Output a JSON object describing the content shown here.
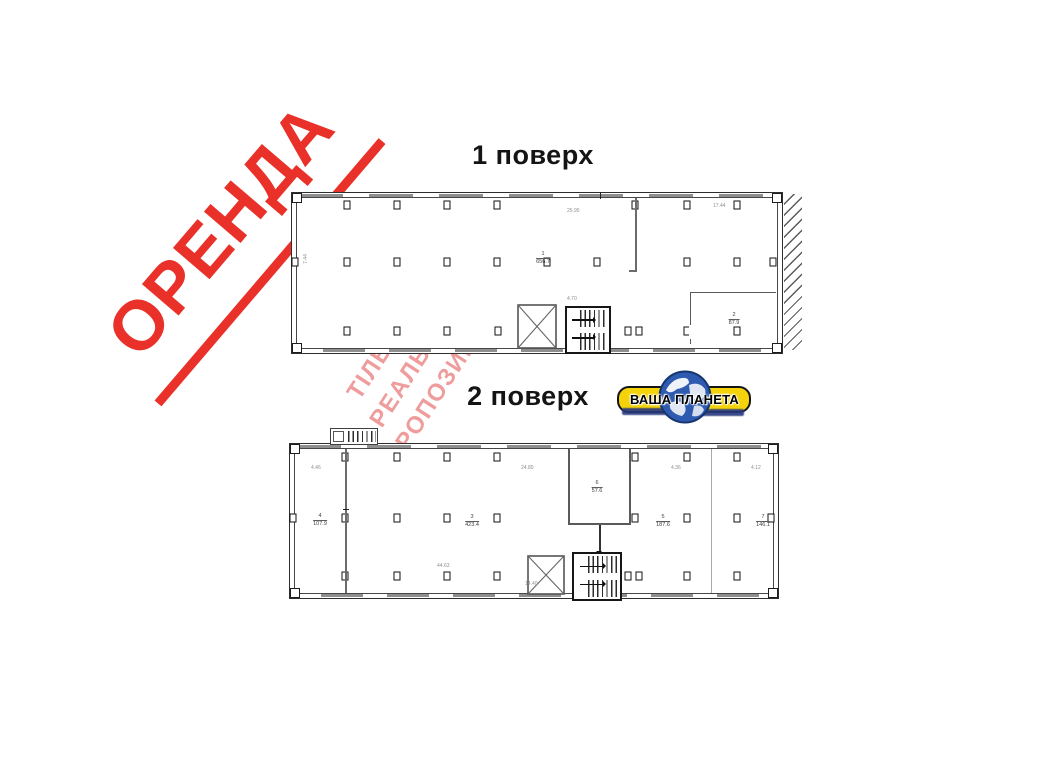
{
  "colors": {
    "stamp_red": "#e9312a",
    "watermark_pink": "#e24a4a",
    "logo_yellow": "#f5d30a",
    "globe_blue": "#2e5bb0",
    "wall_dark": "#2e2e2e",
    "window_gray": "#8f8f8f"
  },
  "stamp": {
    "text": "ОРЕНДА"
  },
  "watermark": {
    "line1": "ТІЛЬКИ",
    "line2": "РЕАЛЬНІ",
    "line3": "ПРОПОЗИЦІЇ"
  },
  "floor1": {
    "title": "1 поверх",
    "room_main": {
      "no": "1",
      "area": "656.7"
    },
    "room_2": {
      "no": "2",
      "area": "87.9"
    },
    "dims": {
      "top": "25.95",
      "top_right": "17.44",
      "left": "7.44",
      "near_stairs": "4.70"
    }
  },
  "floor2": {
    "title": "2 поверх",
    "room_4": {
      "no": "4",
      "area": "107.9"
    },
    "room_main": {
      "no": "3",
      "area": "423.4"
    },
    "room_6": {
      "no": "6",
      "area": "57.6"
    },
    "room_5": {
      "no": "5",
      "area": "187.6"
    },
    "room_7": {
      "no": "7",
      "area": "146.1"
    },
    "dims": {
      "top_left": "4.46",
      "top_mid": "24.80",
      "top_r1": "4.36",
      "top_r2": "4.12",
      "mid": "44.63",
      "low": "14.40"
    }
  },
  "logo": {
    "name": "ВАША ПЛАНЕТА"
  }
}
